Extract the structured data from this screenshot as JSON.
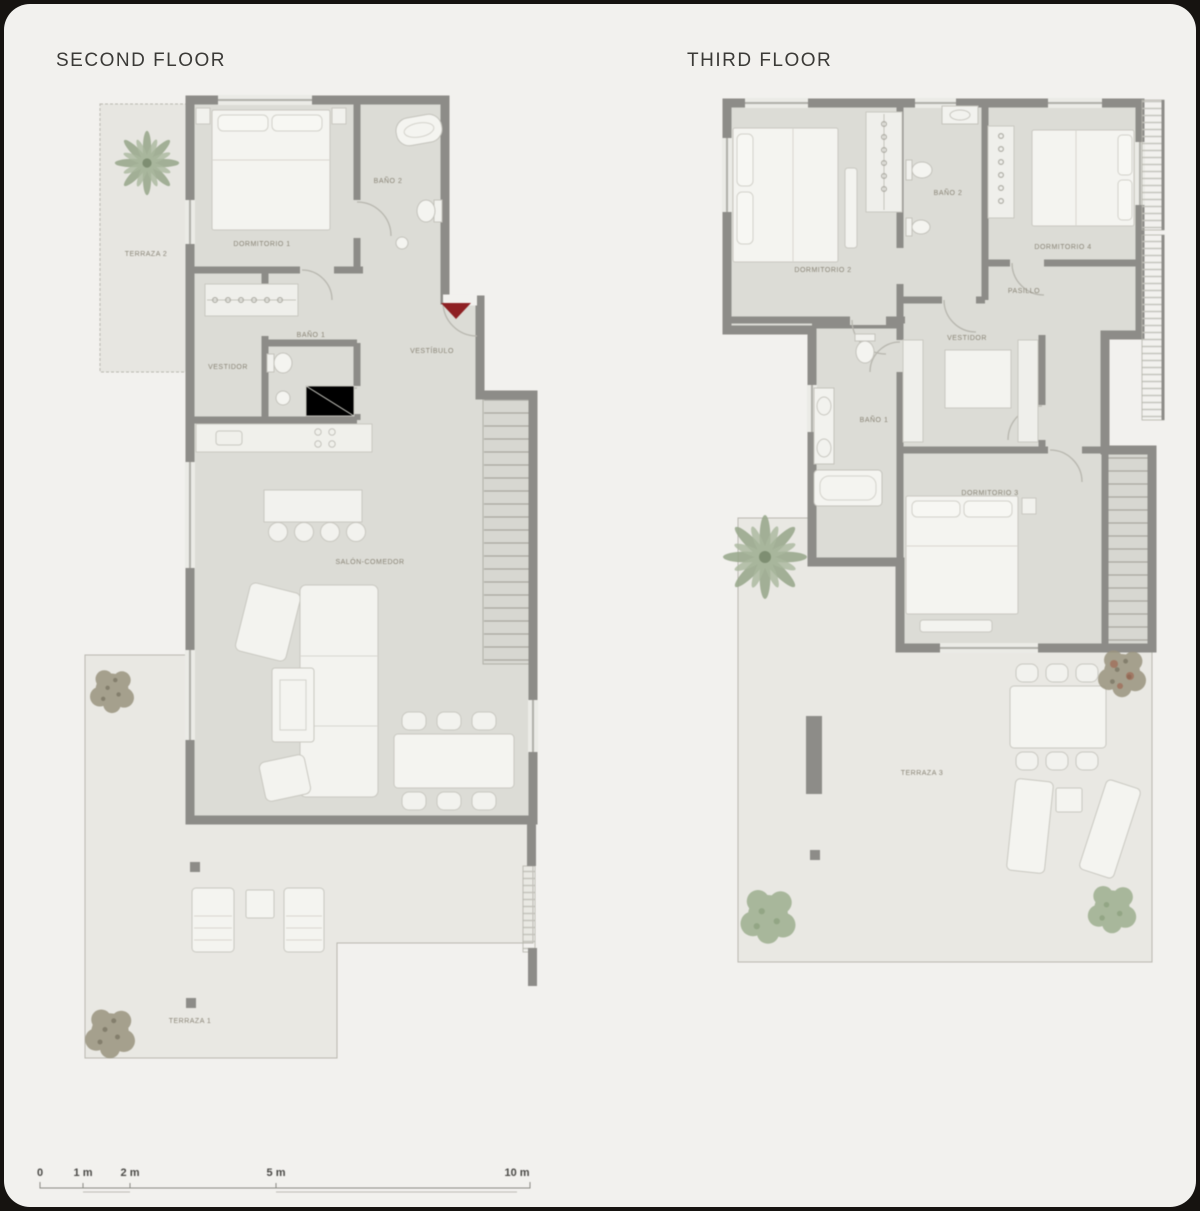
{
  "window": {
    "background": "#161310",
    "panel_background": "#f2f1ee"
  },
  "plans": [
    {
      "title": "SECOND FLOOR",
      "rooms": [
        {
          "label": "TERRAZA 2"
        },
        {
          "label": "DORMITORIO 1"
        },
        {
          "label": "BAÑO 2"
        },
        {
          "label": "VESTIDOR"
        },
        {
          "label": "BAÑO 1"
        },
        {
          "label": "VESTÍBULO"
        },
        {
          "label": "SALÓN-COMEDOR"
        },
        {
          "label": "TERRAZA 1"
        }
      ]
    },
    {
      "title": "THIRD FLOOR",
      "rooms": [
        {
          "label": "DORMITORIO 2"
        },
        {
          "label": "BAÑO 2"
        },
        {
          "label": "DORMITORIO 4"
        },
        {
          "label": "PASILLO"
        },
        {
          "label": "VESTIDOR"
        },
        {
          "label": "BAÑO 1"
        },
        {
          "label": "DORMITORIO 3"
        },
        {
          "label": "TERRAZA 3"
        }
      ]
    }
  ],
  "scale_bar": {
    "labels": [
      "0",
      "1 m",
      "2 m",
      "5 m",
      "10 m"
    ]
  },
  "colors": {
    "wall": "#8d8c88",
    "room_fill": "#dcdcd6",
    "terrace_fill": "#e9e8e3",
    "furniture_fill": "#f4f4f0",
    "entry_arrow": "#8e2023",
    "plant_green": "#9cab8e",
    "tree_brown": "#9a947f",
    "title_text": "#3b3a37",
    "room_label_text": "#8a8577"
  }
}
